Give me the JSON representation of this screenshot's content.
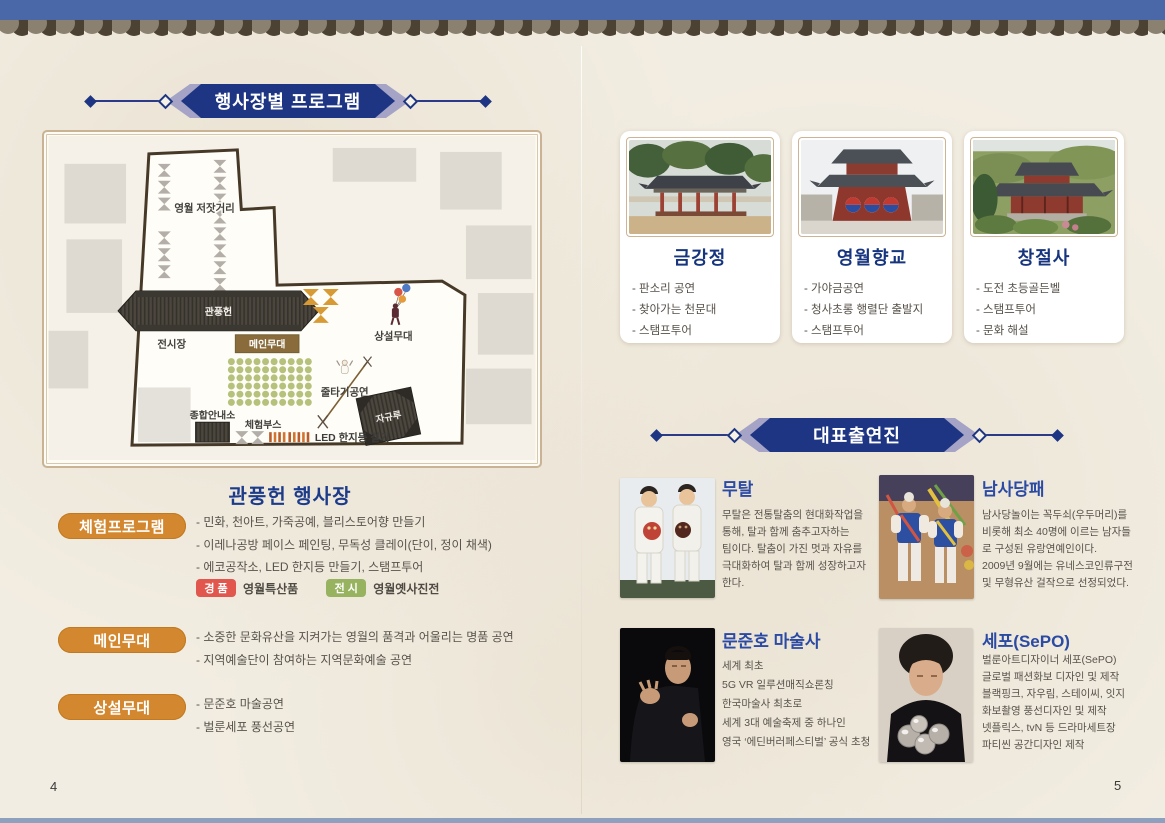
{
  "pages": {
    "left_number": "4",
    "right_number": "5"
  },
  "left": {
    "banner_title": "행사장별 프로그램",
    "map": {
      "market_street": "영월 저잣거리",
      "gwanpungheon": "관풍헌",
      "exhibition": "전시장",
      "main_stage": "메인무대",
      "perm_stage": "상설무대",
      "tightrope": "줄타기공연",
      "info_center": "종합안내소",
      "experience_booth": "체험부스",
      "led_lantern": "LED 한지등 걸기",
      "jagyuru": "자규루"
    },
    "venue_title": "관풍헌 행사장",
    "sections": [
      {
        "label": "체험프로그램",
        "items": [
          "- 민화, 천아트, 가죽공예, 블리스토어향 만들기",
          "- 이레나공방 페이스 페인팅, 무독성 클레이(단이, 정이 채색)",
          "- 에코공작소, LED 한지등 만들기, 스탬프투어"
        ]
      },
      {
        "label": "메인무대",
        "items": [
          "- 소중한 문화유산을 지켜가는 영월의 품격과 어울리는 명품 공연",
          "- 지역예술단이 참여하는 지역문화예술 공연"
        ]
      },
      {
        "label": "상설무대",
        "items": [
          "- 문준호 마술공연",
          "- 벌룬세포 풍선공연"
        ]
      }
    ],
    "badges": [
      {
        "label": "경품",
        "value": "영월특산품"
      },
      {
        "label": "전시",
        "value": "영월옛사진전"
      }
    ]
  },
  "right": {
    "banner_title": "대표출연진",
    "venues": [
      {
        "name": "금강정",
        "items": [
          "- 판소리 공연",
          "- 찾아가는 천문대",
          "- 스탬프투어"
        ]
      },
      {
        "name": "영월향교",
        "items": [
          "- 가야금공연",
          "- 청사초롱 행렬단 출발지",
          "- 스탬프투어"
        ]
      },
      {
        "name": "창절사",
        "items": [
          "- 도전 초등골든벨",
          "- 스탬프투어",
          "- 문화 해설"
        ]
      }
    ],
    "performers": [
      {
        "name": "무탈",
        "desc": "무탈은 전통탈춤의 현대화작업을\n통해, 탈과 함께 춤추고자하는\n팀이다. 탈춤이 가진 멋과 자유를\n극대화하여 탈과 함께 성장하고자\n한다."
      },
      {
        "name": "남사당패",
        "desc": "남사당놀이는 꼭두쇠(우두머리)를\n비롯해 최소 40명에 이르는 남자들\n로 구성된 유랑연예인이다.\n2009년 9월에는 유네스코인류구전\n및 무형유산 걸작으로 선정되었다."
      },
      {
        "name": "문준호 마술사",
        "desc": "세계 최초\n5G  VR 일루션매직쇼론칭\n한국마술사 최초로\n세계 3대 예술축제 중 하나인\n영국 ‘에딘버러페스티벌’ 공식 초청"
      },
      {
        "name": "세포(SePO)",
        "desc": "벌룬아트디자이너 세포(SePO)\n글로벌 패션화보 디자인 및 제작\n블랙핑크, 자우림, 스테이씨, 잇지\n화보촬영 풍선디자인 및 제작\n넷플릭스, tvN 등 드라마세트장\n파티씬 공간디자인 제작"
      }
    ]
  },
  "colors": {
    "roof_blue": "#4a68a7",
    "roof_tile_light": "#8b8170",
    "roof_tile_dark": "#4b4233",
    "banner_navy": "#1d3583",
    "banner_lavender": "#a5a3c6",
    "badge_orange": "#d3872e",
    "badge_red": "#e2574d",
    "badge_green": "#97b360",
    "title_navy": "#17357f",
    "performer_name_blue": "#2b4aa3",
    "paper": "#f2ede2"
  }
}
